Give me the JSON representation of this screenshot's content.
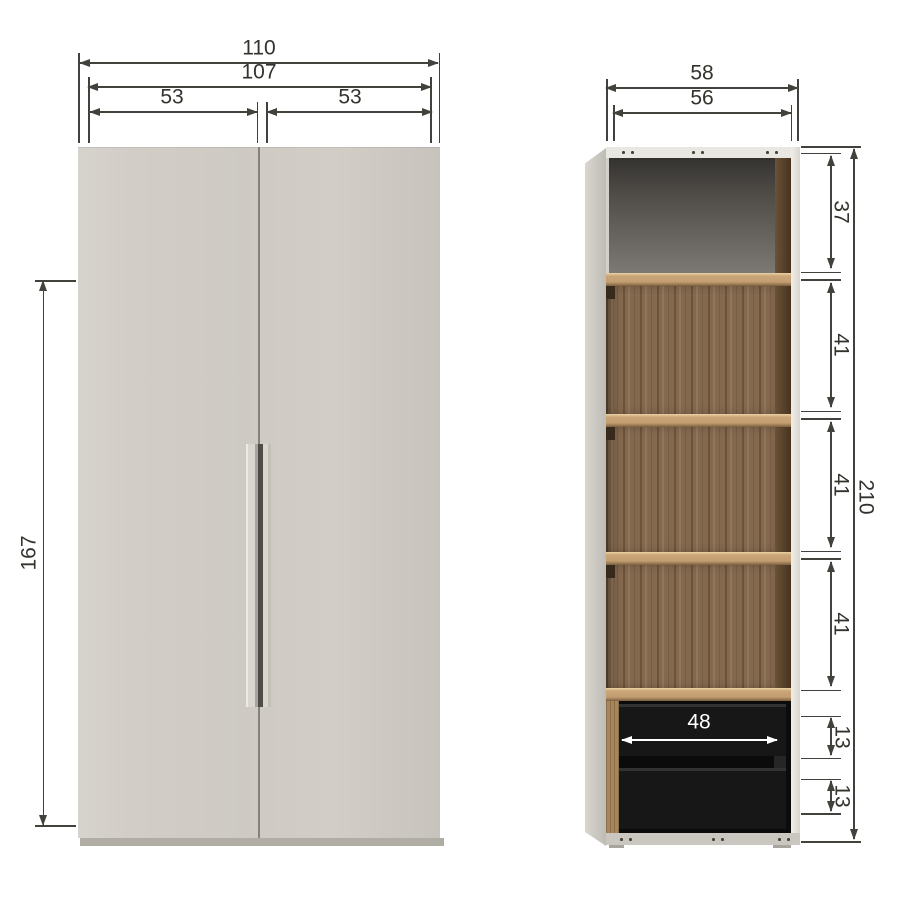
{
  "drawing": {
    "front_view": {
      "overall_width": "110",
      "inner_width": "107",
      "left_door_width": "53",
      "right_door_width": "53",
      "door_height": "167"
    },
    "side_view": {
      "overall_depth": "58",
      "inner_depth": "56",
      "top_compartment_height": "37",
      "shelf_compartment_1_height": "41",
      "shelf_compartment_2_height": "41",
      "shelf_compartment_3_height": "41",
      "total_height": "210",
      "drawer_inner_width": "48",
      "drawer_1_height": "13",
      "drawer_2_height": "13"
    },
    "colors": {
      "door": "#d2cec7",
      "walnut": "#84694e",
      "shelf_edge": "#c9a473",
      "drawer_front": "#171717",
      "dimension_line": "#43413c"
    }
  }
}
